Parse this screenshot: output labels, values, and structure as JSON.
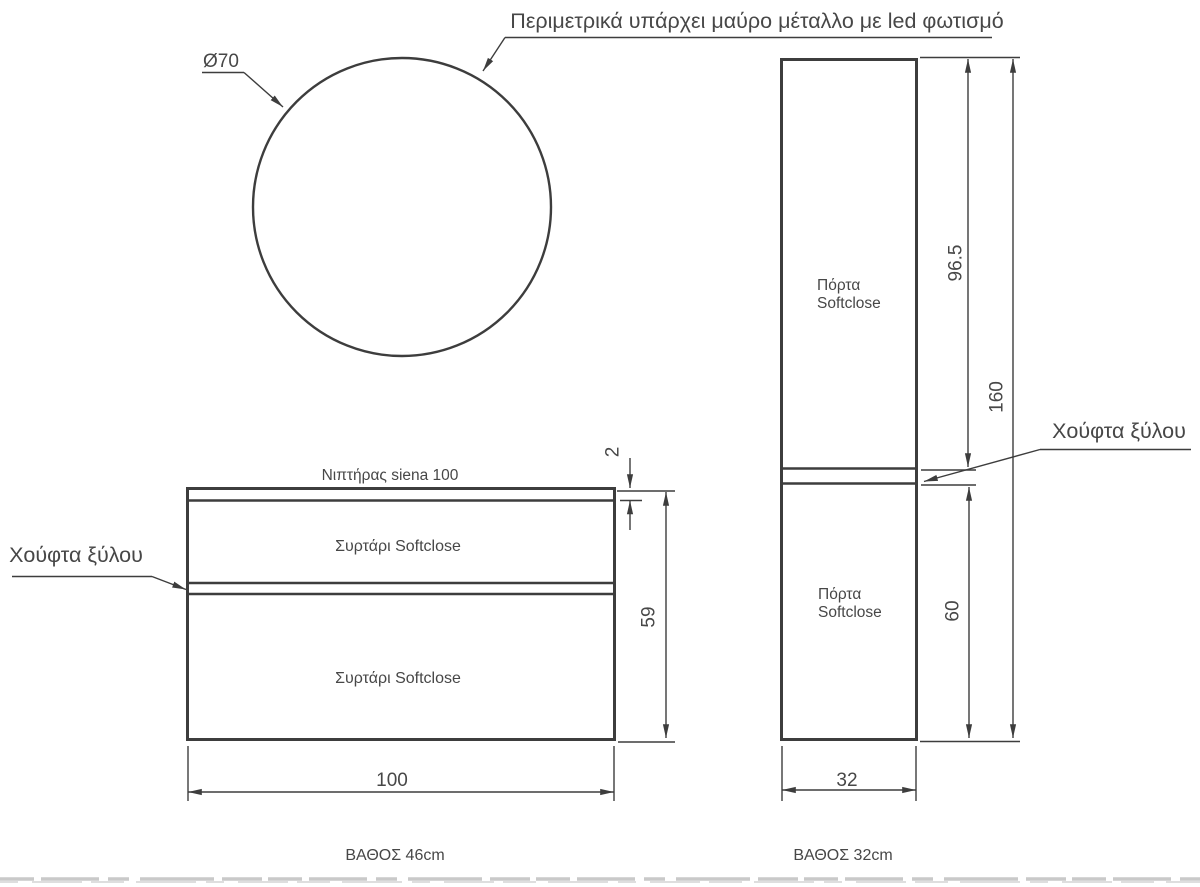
{
  "colors": {
    "background": "#ffffff",
    "line": "#3d3d3d",
    "text": "#474747",
    "footer_rule": "#c9c9c9"
  },
  "notes": {
    "perimeter": "Περιμετρικά υπάρχει μαύρο μέταλλο με led φωτισμό",
    "wood_handle_left": "Χούφτα ξύλου",
    "wood_handle_right": "Χούφτα ξύλου"
  },
  "mirror": {
    "diameter": "Ø70"
  },
  "vanity": {
    "sink": "Νιπτήρας siena 100",
    "drawer_top": "Συρτάρι Softclose",
    "drawer_bottom": "Συρτάρι Softclose",
    "dim_counter_thickness": "2",
    "dim_height": "59",
    "dim_width": "100",
    "depth": "ΒΑΘΟΣ 46cm"
  },
  "tall_cabinet": {
    "door_top_line1": "Πόρτα",
    "door_top_line2": "Softclose",
    "door_bottom_line1": "Πόρτα",
    "door_bottom_line2": "Softclose",
    "dim_door_top": "96.5",
    "dim_total": "160",
    "dim_door_bottom": "60",
    "dim_width": "32",
    "depth": "ΒΑΘΟΣ 32cm"
  }
}
